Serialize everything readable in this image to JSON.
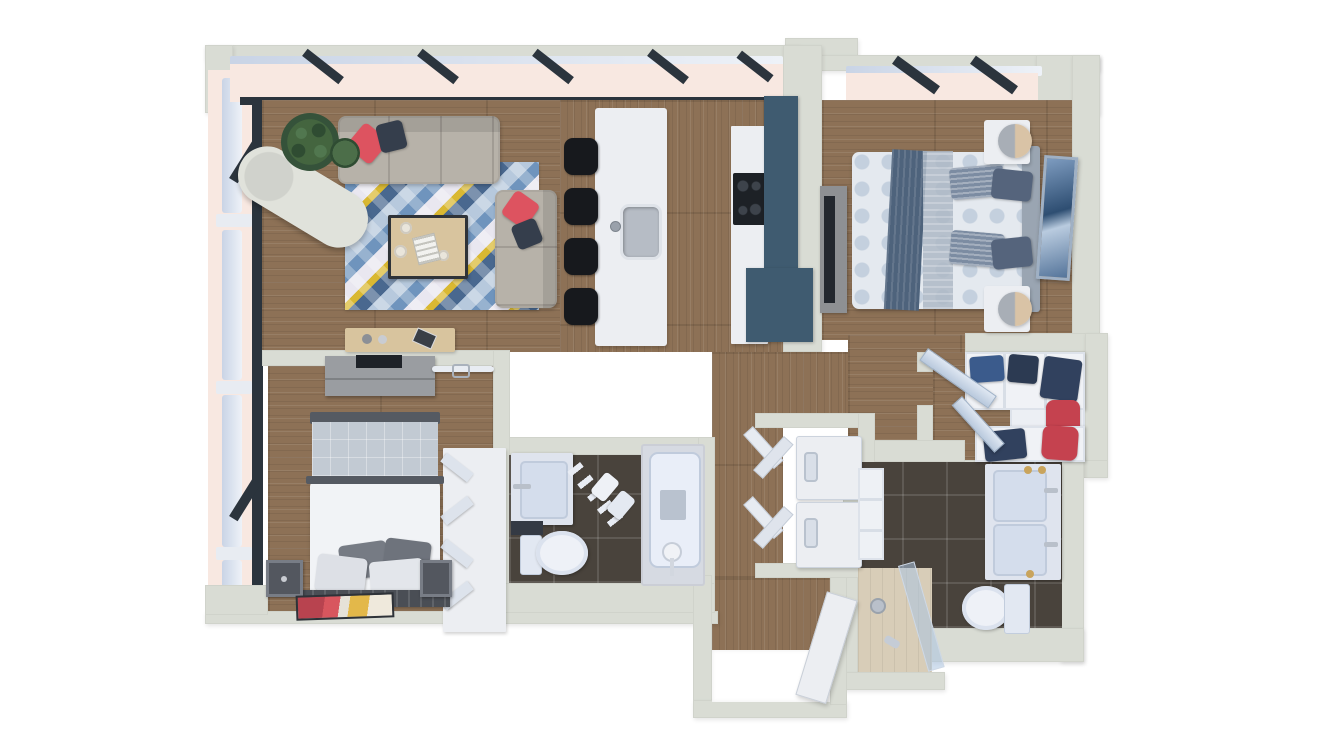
{
  "meta": {
    "kind": "3d-rendered-floor-plan",
    "view": "top-down dollhouse",
    "unit_type": "two-bedroom apartment"
  },
  "palette": {
    "exterior": "#ffffff",
    "wall": "#d9dcd4",
    "wall-dark": "#c3c7bd",
    "wood": "#8d7156",
    "tile": "#49433c",
    "glass": "#f8e8e1",
    "frame-light": "#c9d4e6",
    "frame-dark": "#2b343d",
    "cabinet-teal": "#3f5b70",
    "furniture-white": "#eceef2",
    "appliance-black": "#17191d",
    "sofa": "#b7b2a9",
    "pillow-red": "#dd5360",
    "pillow-navy": "#353e4c",
    "rug-blue": "#6f94bd",
    "rug-lightblue": "#b7c9dd",
    "rug-yellow": "#d9b832",
    "rug-cream": "#e9e7f0",
    "rug-navy": "#49688f",
    "table-wood": "#d8c49e",
    "bed-pattern": "#e4e9ef",
    "bed-dot": "#c4d0de",
    "throw-blue": "#4e637c",
    "blanket-gray": "#c2cad3",
    "bedframe-dark": "#4a4e55",
    "fixture": "#e7ecf6",
    "fixture-border": "#c0cbdc",
    "clothes-navy": "#31415e",
    "clothes-red": "#c5424f",
    "lamp-tan": "#d9c3a6",
    "lamp-gray": "#a8aeb6",
    "shower-tile": "#d8cdb8",
    "plant-green": "#3c5a3e"
  },
  "rooms": [
    {
      "id": "living-room",
      "label": "Living room",
      "furniture": [
        "three-seat-sofa",
        "loveseat",
        "geometric-area-rug",
        "coffee-table",
        "chaise-lounge",
        "potted-plant",
        "console-table"
      ]
    },
    {
      "id": "kitchen",
      "label": "Open kitchen",
      "furniture": [
        "island-with-sink",
        "four-bar-stools",
        "cooktop-counter",
        "tall-teal-cabinet",
        "lower-teal-cabinet"
      ]
    },
    {
      "id": "master-bedroom",
      "label": "Main bedroom",
      "furniture": [
        "double-bed",
        "throw-blanket",
        "two-nightstands",
        "two-lamps",
        "leaning-mirror",
        "tv-dresser"
      ]
    },
    {
      "id": "second-bedroom",
      "label": "Second bedroom",
      "furniture": [
        "double-bed",
        "two-dark-nightstands",
        "wall-tv-unit",
        "open-closet-rod",
        "wardrobe",
        "art-rug"
      ]
    },
    {
      "id": "bathroom",
      "label": "Bathroom",
      "furniture": [
        "vanity-sink",
        "toilet",
        "bathtub",
        "towel-ladder",
        "paper-holder"
      ]
    },
    {
      "id": "master-bathroom",
      "label": "En-suite bathroom",
      "furniture": [
        "double-vanity",
        "toilet",
        "walk-in-shower",
        "storage-shelf"
      ]
    },
    {
      "id": "walk-in-closet",
      "label": "Walk-in closet",
      "furniture": [
        "shelving-with-clothes",
        "mirrored-doors"
      ]
    },
    {
      "id": "laundry-closet",
      "label": "Laundry closet",
      "furniture": [
        "stacked-washer-dryer",
        "bifold-doors"
      ]
    },
    {
      "id": "hallway",
      "label": "Hallway",
      "furniture": []
    },
    {
      "id": "entry",
      "label": "Entry",
      "furniture": [
        "entry-door",
        "door-mat"
      ]
    }
  ]
}
